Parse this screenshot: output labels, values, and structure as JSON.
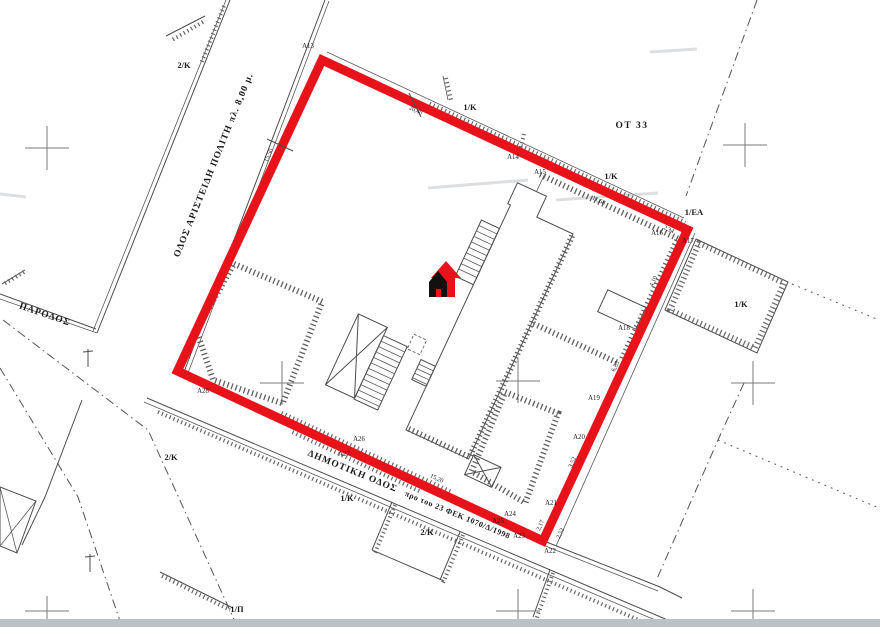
{
  "map": {
    "streets": {
      "aristidi_politi": {
        "label": "ΟΔΟΣ ΑΡΙΣΤΕΙΔΗ ΠΟΛΙΤΗ  πλ. 8,00 μ."
      },
      "parodos": {
        "label": "ΠΑΡΟΔΟΣ"
      },
      "dimotiki": {
        "label": "ΔΗΜΟΤΙΚΗ ΟΔΟΣ",
        "note": "προ του 23 ΦΕΚ 1070/Δ/1998"
      }
    },
    "block_label": "ΟΤ 33",
    "parcel_labels": [
      {
        "text": "2/K",
        "x": 184,
        "y": 68
      },
      {
        "text": "1/K",
        "x": 470,
        "y": 110
      },
      {
        "text": "1/K",
        "x": 611,
        "y": 179
      },
      {
        "text": "1/ΕΑ",
        "x": 694,
        "y": 215
      },
      {
        "text": "1/K",
        "x": 741,
        "y": 307
      },
      {
        "text": "2/K",
        "x": 171,
        "y": 460
      },
      {
        "text": "1/K",
        "x": 347,
        "y": 501
      },
      {
        "text": "2/K",
        "x": 427,
        "y": 535
      },
      {
        "text": "1/Π",
        "x": 237,
        "y": 612
      }
    ],
    "point_labels": [
      {
        "text": "A13",
        "x": 308,
        "y": 48
      },
      {
        "text": "A14",
        "x": 513,
        "y": 159
      },
      {
        "text": "A15",
        "x": 540,
        "y": 174
      },
      {
        "text": "A16",
        "x": 657,
        "y": 235
      },
      {
        "text": "A17",
        "x": 688,
        "y": 243
      },
      {
        "text": "A18",
        "x": 624,
        "y": 330
      },
      {
        "text": "A19",
        "x": 594,
        "y": 400
      },
      {
        "text": "A20",
        "x": 579,
        "y": 439
      },
      {
        "text": "A21",
        "x": 551,
        "y": 505
      },
      {
        "text": "A22",
        "x": 550,
        "y": 553
      },
      {
        "text": "A23",
        "x": 519,
        "y": 538
      },
      {
        "text": "A24",
        "x": 510,
        "y": 516
      },
      {
        "text": "A25",
        "x": 498,
        "y": 523
      },
      {
        "text": "A26",
        "x": 359,
        "y": 441
      },
      {
        "text": "A27",
        "x": 344,
        "y": 456
      },
      {
        "text": "A28",
        "x": 203,
        "y": 393
      }
    ],
    "dimension_labels": [
      {
        "text": "15,50",
        "x": 270,
        "y": 156,
        "rot": -66
      },
      {
        "text": "20,40",
        "x": 415,
        "y": 112,
        "rot": 25
      },
      {
        "text": "11,68",
        "x": 598,
        "y": 202,
        "rot": 25
      },
      {
        "text": "2,34",
        "x": 668,
        "y": 231,
        "rot": 25
      },
      {
        "text": "4,10",
        "x": 655,
        "y": 282,
        "rot": -66
      },
      {
        "text": "6,85",
        "x": 617,
        "y": 367,
        "rot": -66
      },
      {
        "text": "3,52",
        "x": 574,
        "y": 463,
        "rot": -66
      },
      {
        "text": "2,17",
        "x": 542,
        "y": 526,
        "rot": -66
      },
      {
        "text": "2,52",
        "x": 562,
        "y": 534,
        "rot": -66
      },
      {
        "text": "15,20",
        "x": 436,
        "y": 480,
        "rot": 25
      }
    ],
    "colors": {
      "boundary": "#e8121b",
      "marker_black": "#111111",
      "bottom_bar": "#bdc1c6"
    }
  }
}
